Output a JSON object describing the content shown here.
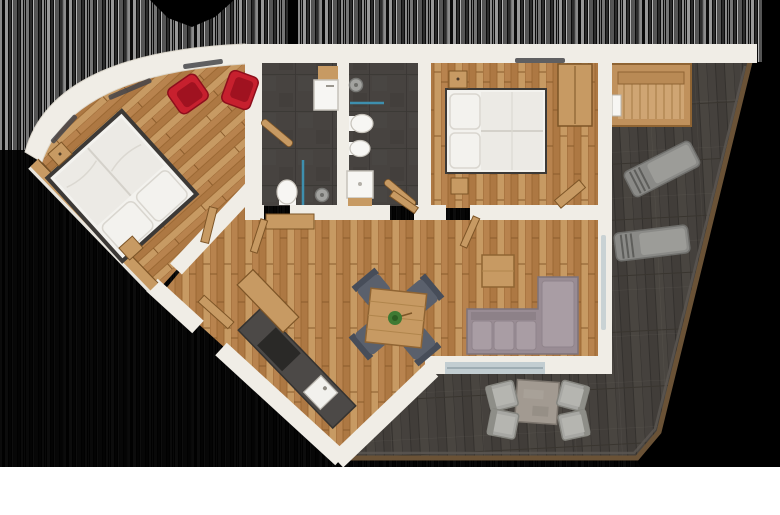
{
  "scene": {
    "title": "apartment-floor-plan-3d-render",
    "view": "top-down",
    "width": 780,
    "height": 515
  },
  "palette": {
    "bg": "#000000",
    "bg_bottom": "#ffffff",
    "stripe_dark": "#0b0b0b",
    "wall": "#f0ede6",
    "wall_edge": "#d8d2c6",
    "wood": "#b8834e",
    "wood_mid": "#ad7843",
    "wood_light": "#c79a63",
    "wood_dark": "#8f6433",
    "tile": "#474340",
    "tile_line": "#393633",
    "deck": "#45413d",
    "deck_line": "#322f2c",
    "deck_trim": "#6a5236",
    "deck_rim": "#5b5651",
    "bed": "#f3f2ee",
    "bed_fold": "#dcdad4",
    "frame": "#3c3936",
    "sofa": "#998c94",
    "sofa_cushion": "#a99da4",
    "red_chair": "#c7202e",
    "red_chair_dark": "#a01220",
    "slate_chair": "#5a606c",
    "slate_chair_dark": "#474d59",
    "lounger": "#8a8a87",
    "lounger_pad": "#9c9c98",
    "outdoor_chair": "#a7a7a3",
    "stone_table": "#a29a91",
    "counter": "#4c4947",
    "cooktop": "#2a2927",
    "sink": "#f2f1ed",
    "glass_blue": "#3e8fae",
    "glass_light": "#c2cdd1",
    "plant": "#3f7a33",
    "fixture": "#f7f6f3",
    "window_slit": "#45454a",
    "sauna_wood": "#c0915c",
    "sauna_floor": "#cfa573"
  },
  "rooms": [
    {
      "id": "bedroom-1",
      "position": "top-left",
      "floor": "diagonal-parquet"
    },
    {
      "id": "bathroom-1",
      "position": "top-center-left",
      "floor": "dark-tile"
    },
    {
      "id": "bathroom-2",
      "position": "top-center-right",
      "floor": "dark-tile"
    },
    {
      "id": "bedroom-2",
      "position": "top-right",
      "floor": "parquet"
    },
    {
      "id": "living-kitchen",
      "position": "center",
      "floor": "parquet"
    },
    {
      "id": "terrace",
      "position": "right-and-bottom",
      "floor": "dark-decking"
    }
  ],
  "furniture": [
    {
      "id": "double-bed-1",
      "room": "bedroom-1"
    },
    {
      "id": "red-armchair-1",
      "room": "bedroom-1"
    },
    {
      "id": "red-armchair-2",
      "room": "bedroom-1"
    },
    {
      "id": "nightstand",
      "room": "bedroom-1"
    },
    {
      "id": "double-bed-2",
      "room": "bedroom-2"
    },
    {
      "id": "wardrobe",
      "room": "bedroom-2"
    },
    {
      "id": "sink-vanity",
      "room": "bathroom-1"
    },
    {
      "id": "toilet",
      "room": "bathroom-1"
    },
    {
      "id": "shower",
      "room": "bathroom-1"
    },
    {
      "id": "toilet-and-bidet",
      "room": "bathroom-2"
    },
    {
      "id": "shower-tray",
      "room": "bathroom-2"
    },
    {
      "id": "kitchen-counter",
      "room": "living-kitchen"
    },
    {
      "id": "dining-table-with-plant",
      "room": "living-kitchen"
    },
    {
      "id": "dining-chairs",
      "room": "living-kitchen"
    },
    {
      "id": "l-shaped-sofa",
      "room": "living-kitchen"
    },
    {
      "id": "coffee-table",
      "room": "living-kitchen"
    },
    {
      "id": "sauna-daybed",
      "room": "terrace"
    },
    {
      "id": "sun-lounger-1",
      "room": "terrace"
    },
    {
      "id": "sun-lounger-2",
      "room": "terrace"
    },
    {
      "id": "outdoor-dining-set",
      "room": "terrace"
    }
  ]
}
